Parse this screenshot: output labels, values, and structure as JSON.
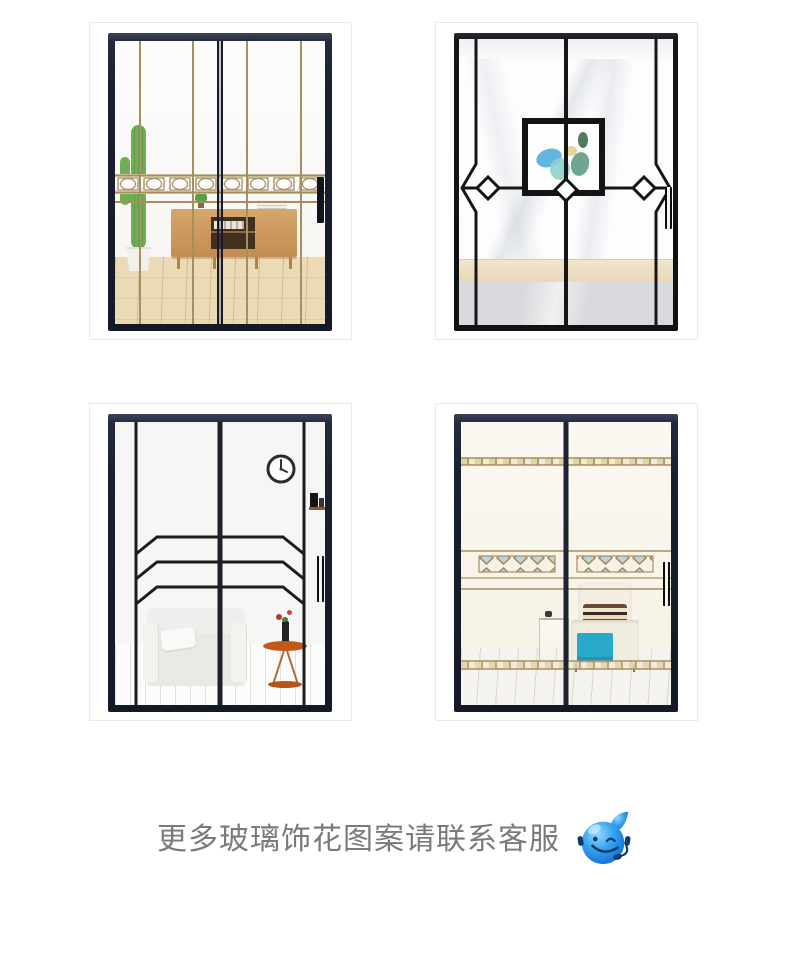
{
  "page": {
    "background": "#ffffff"
  },
  "products": [
    {
      "name": "sliding-door-gold-vertical-lines",
      "alt": "金色竖线条装饰玻璃移门效果图"
    },
    {
      "name": "sliding-door-black-diamond-center-art",
      "alt": "黑色线条菱形画芯玻璃移门效果图"
    },
    {
      "name": "sliding-door-black-chevron-lines",
      "alt": "黑色折线纹玻璃移门效果图"
    },
    {
      "name": "sliding-door-gold-diamond-bands",
      "alt": "金色菱形横带装饰玻璃移门效果图"
    }
  ],
  "footer": {
    "text": "更多玻璃饰花图案请联系客服",
    "mascot_icon": "customer-service-mascot-icon"
  },
  "colors": {
    "card_border": "#eaeaea",
    "door_frame_navy": "#1c2231",
    "door_frame_black": "#131419",
    "gold_line": "#a68f5e",
    "pattern_black": "#1f1f1f",
    "diamond_fill_blue": "#b7d6e2",
    "art_blue": "#47a8dc",
    "cactus_green": "#6fae53",
    "cabinet_wood": "#c9935a",
    "wood_floor": "#ecd9b6",
    "throw_teal": "#28a9c9",
    "side_table_orange": "#c2591b",
    "footer_text": "#7a7a7a",
    "mascot_blue": "#2a9bea"
  }
}
